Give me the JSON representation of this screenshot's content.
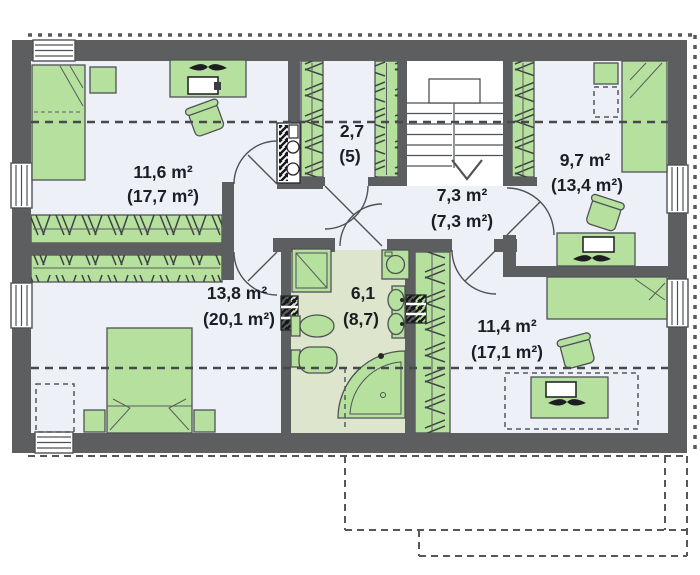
{
  "plan": {
    "type": "floor-plan-upper-storey",
    "rooms": [
      {
        "key": "bedroom-top-left",
        "area": "11,6 m²",
        "gross_area": "(17,7 m²)"
      },
      {
        "key": "wardrobe",
        "area": "2,7",
        "gross_area": "(5)"
      },
      {
        "key": "hall",
        "area": "7,3 m²",
        "gross_area": "(7,3 m²)"
      },
      {
        "key": "bedroom-top-right",
        "area": "9,7 m²",
        "gross_area": "(13,4 m²)"
      },
      {
        "key": "bedroom-bottom-left",
        "area": "13,8 m²",
        "gross_area": "(20,1 m²)"
      },
      {
        "key": "bathroom",
        "area": "6,1",
        "gross_area": "(8,7)"
      },
      {
        "key": "bedroom-bottom-right",
        "area": "11,4 m²",
        "gross_area": "(17,1 m²)"
      }
    ],
    "colors": {
      "wall": "#5c5e60",
      "floor": "#edf1f7",
      "bathroom_floor": "#dde6cd",
      "furniture": "#b6e09d",
      "outline": "#4e5255",
      "dashed_line": "#46494d",
      "text": "#1c1e21",
      "window": "#ffffff",
      "background": "#ffffff"
    }
  }
}
